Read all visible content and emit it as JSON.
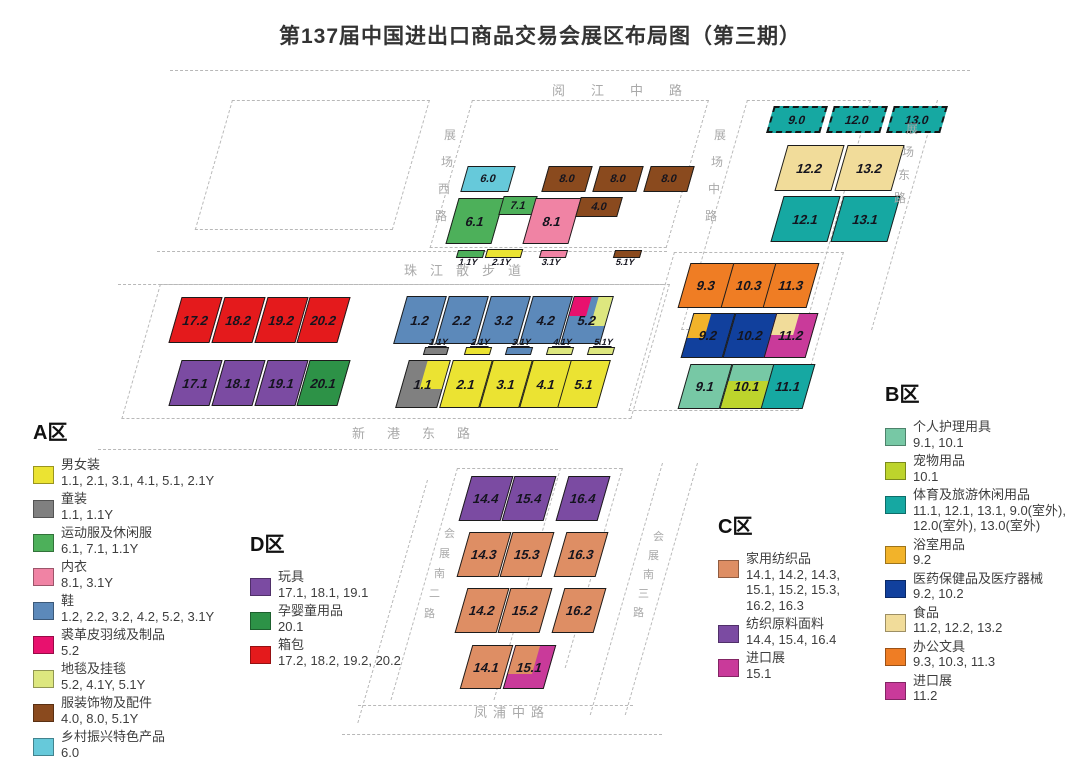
{
  "title": "第137届中国进出口商品交易会展区布局图（第三期）",
  "colors": {
    "yellow": "#ebe332",
    "gray": "#808080",
    "green": "#4db05a",
    "green2": "#2d9247",
    "pink": "#f083a4",
    "blue": "#5c89ba",
    "magentaA": "#e8116e",
    "lightgreen": "#dde77f",
    "brown": "#8a4a1e",
    "cyan": "#66c9da",
    "purple": "#7b4ba2",
    "red": "#e41a1c",
    "tan": "#de8e64",
    "magentaC": "#c93a9a",
    "tealLight": "#77c8a5",
    "yellowGreen": "#bdd42c",
    "teal": "#16a8a2",
    "amber": "#f2b32a",
    "darkblue": "#11409d",
    "cream": "#f1dc9a",
    "orange": "#ef7d24"
  },
  "roads": [
    {
      "name": "阅江中路"
    },
    {
      "name": "展场西路"
    },
    {
      "name": "展场中路"
    },
    {
      "name": "展场东路"
    },
    {
      "name": "珠江散步道"
    },
    {
      "name": "新港东路"
    },
    {
      "name": "会展南二路"
    },
    {
      "name": "会展南三路"
    },
    {
      "name": "凤浦中路"
    }
  ],
  "halls": [
    {
      "label": "9.0",
      "x": 770,
      "y": 106,
      "w": 54,
      "h": 27,
      "c": "teal",
      "outdoor": true,
      "fs": 12
    },
    {
      "label": "12.0",
      "x": 830,
      "y": 106,
      "w": 54,
      "h": 27,
      "c": "teal",
      "outdoor": true,
      "fs": 12
    },
    {
      "label": "13.0",
      "x": 890,
      "y": 106,
      "w": 54,
      "h": 27,
      "c": "teal",
      "outdoor": true,
      "fs": 12
    },
    {
      "label": "12.2",
      "x": 781,
      "y": 145,
      "w": 57,
      "h": 46,
      "c": "cream"
    },
    {
      "label": "13.2",
      "x": 841,
      "y": 145,
      "w": 57,
      "h": 46,
      "c": "cream"
    },
    {
      "label": "12.1",
      "x": 777,
      "y": 196,
      "w": 57,
      "h": 46,
      "c": "teal"
    },
    {
      "label": "13.1",
      "x": 837,
      "y": 196,
      "w": 57,
      "h": 46,
      "c": "teal"
    },
    {
      "label": "6.0",
      "x": 464,
      "y": 166,
      "w": 48,
      "h": 26,
      "c": "cyan",
      "fs": 11
    },
    {
      "label": "8.0",
      "x": 545,
      "y": 166,
      "w": 44,
      "h": 26,
      "c": "brown",
      "fs": 11
    },
    {
      "label": "8.0",
      "x": 596,
      "y": 166,
      "w": 44,
      "h": 26,
      "c": "brown",
      "fs": 11
    },
    {
      "label": "8.0",
      "x": 647,
      "y": 166,
      "w": 44,
      "h": 26,
      "c": "brown",
      "fs": 11
    },
    {
      "label": "6.1",
      "x": 452,
      "y": 198,
      "w": 46,
      "h": 46,
      "c": "green"
    },
    {
      "label": "7.1",
      "x": 501,
      "y": 196,
      "w": 34,
      "h": 19,
      "c": "green",
      "fs": 11
    },
    {
      "label": "8.1",
      "x": 529,
      "y": 198,
      "w": 46,
      "h": 46,
      "c": "pink"
    },
    {
      "label": "4.0",
      "x": 578,
      "y": 197,
      "w": 42,
      "h": 20,
      "c": "brown",
      "fs": 11
    },
    {
      "label": "1.1Y",
      "x": 457,
      "y": 250,
      "w": 27,
      "h": 8,
      "c": "green",
      "strip": "below"
    },
    {
      "label": "2.1Y",
      "x": 486,
      "y": 249,
      "w": 36,
      "h": 9,
      "c": "yellow",
      "strip": "below"
    },
    {
      "label": "3.1Y",
      "x": 540,
      "y": 250,
      "w": 27,
      "h": 8,
      "c": "pink",
      "strip": "below"
    },
    {
      "label": "5.1Y",
      "x": 614,
      "y": 250,
      "w": 27,
      "h": 8,
      "c": "brown",
      "strip": "below"
    },
    {
      "label": "17.2",
      "x": 175,
      "y": 297,
      "w": 41,
      "h": 46,
      "c": "red"
    },
    {
      "label": "18.2",
      "x": 218,
      "y": 297,
      "w": 41,
      "h": 46,
      "c": "red"
    },
    {
      "label": "19.2",
      "x": 261,
      "y": 297,
      "w": 41,
      "h": 46,
      "c": "red"
    },
    {
      "label": "20.2",
      "x": 303,
      "y": 297,
      "w": 41,
      "h": 46,
      "c": "red"
    },
    {
      "label": "17.1",
      "x": 175,
      "y": 360,
      "w": 41,
      "h": 46,
      "c": "purple"
    },
    {
      "label": "18.1",
      "x": 218,
      "y": 360,
      "w": 41,
      "h": 46,
      "c": "purple"
    },
    {
      "label": "19.1",
      "x": 261,
      "y": 360,
      "w": 41,
      "h": 46,
      "c": "purple"
    },
    {
      "label": "20.1",
      "x": 303,
      "y": 360,
      "w": 41,
      "h": 46,
      "c": "green2"
    },
    {
      "label": "1.2",
      "x": 400,
      "y": 296,
      "w": 40,
      "h": 48,
      "c": "blue"
    },
    {
      "label": "2.2",
      "x": 442,
      "y": 296,
      "w": 40,
      "h": 48,
      "c": "blue"
    },
    {
      "label": "3.2",
      "x": 484,
      "y": 296,
      "w": 40,
      "h": 48,
      "c": "blue"
    },
    {
      "label": "4.2",
      "x": 526,
      "y": 296,
      "w": 40,
      "h": 48,
      "c": "blue"
    },
    {
      "label": "5.2",
      "x": 567,
      "y": 296,
      "w": 40,
      "h": 48,
      "c": "blue",
      "parts": [
        {
          "c": "magentaA",
          "s": "left:0;top:0;width:45%;height:42%"
        },
        {
          "c": "lightgreen",
          "s": "left:62%;top:0;width:38%;height:62%"
        }
      ]
    },
    {
      "label": "1.1Y",
      "x": 424,
      "y": 347,
      "w": 24,
      "h": 8,
      "c": "gray",
      "strip": "above"
    },
    {
      "label": "2.1Y",
      "x": 465,
      "y": 347,
      "w": 26,
      "h": 8,
      "c": "yellow",
      "strip": "above"
    },
    {
      "label": "3.1Y",
      "x": 506,
      "y": 347,
      "w": 26,
      "h": 8,
      "c": "blue",
      "strip": "above"
    },
    {
      "label": "4.1Y",
      "x": 547,
      "y": 347,
      "w": 26,
      "h": 8,
      "c": "lightgreen",
      "strip": "above"
    },
    {
      "label": "5.1Y",
      "x": 588,
      "y": 347,
      "w": 26,
      "h": 8,
      "c": "lightgreen",
      "strip": "above"
    },
    {
      "label": "1.1",
      "x": 402,
      "y": 360,
      "w": 42,
      "h": 48,
      "c": "gray",
      "parts": [
        {
          "c": "yellow",
          "s": "left:45%;top:0;width:55%;height:60%"
        }
      ]
    },
    {
      "label": "2.1",
      "x": 446,
      "y": 360,
      "w": 40,
      "h": 48,
      "c": "yellow"
    },
    {
      "label": "3.1",
      "x": 486,
      "y": 360,
      "w": 40,
      "h": 48,
      "c": "yellow"
    },
    {
      "label": "4.1",
      "x": 526,
      "y": 360,
      "w": 40,
      "h": 48,
      "c": "yellow"
    },
    {
      "label": "5.1",
      "x": 564,
      "y": 360,
      "w": 40,
      "h": 48,
      "c": "yellow"
    },
    {
      "label": "9.3",
      "x": 684,
      "y": 263,
      "w": 44,
      "h": 45,
      "c": "orange"
    },
    {
      "label": "10.3",
      "x": 727,
      "y": 263,
      "w": 44,
      "h": 45,
      "c": "orange"
    },
    {
      "label": "11.3",
      "x": 769,
      "y": 263,
      "w": 44,
      "h": 45,
      "c": "orange"
    },
    {
      "label": "9.2",
      "x": 687,
      "y": 313,
      "w": 42,
      "h": 45,
      "c": "darkblue",
      "parts": [
        {
          "c": "amber",
          "s": "left:0;top:0;width:42%;height:55%"
        }
      ]
    },
    {
      "label": "10.2",
      "x": 729,
      "y": 313,
      "w": 42,
      "h": 45,
      "c": "darkblue"
    },
    {
      "label": "11.2",
      "x": 770,
      "y": 313,
      "w": 42,
      "h": 45,
      "c": "magentaC",
      "parts": [
        {
          "c": "cream",
          "s": "left:0;top:0;width:55%;height:48%"
        }
      ]
    },
    {
      "label": "9.1",
      "x": 684,
      "y": 364,
      "w": 42,
      "h": 45,
      "c": "tealLight"
    },
    {
      "label": "10.1",
      "x": 726,
      "y": 364,
      "w": 42,
      "h": 45,
      "c": "tealLight",
      "parts": [
        {
          "c": "yellowGreen",
          "s": "left:0;top:38%;width:100%;height:62%"
        }
      ]
    },
    {
      "label": "11.1",
      "x": 767,
      "y": 364,
      "w": 42,
      "h": 45,
      "c": "teal"
    },
    {
      "label": "14.4",
      "x": 465,
      "y": 476,
      "w": 42,
      "h": 45,
      "c": "purple"
    },
    {
      "label": "15.4",
      "x": 508,
      "y": 476,
      "w": 42,
      "h": 45,
      "c": "purple"
    },
    {
      "label": "16.4",
      "x": 562,
      "y": 476,
      "w": 42,
      "h": 45,
      "c": "purple"
    },
    {
      "label": "14.3",
      "x": 463,
      "y": 532,
      "w": 42,
      "h": 45,
      "c": "tan"
    },
    {
      "label": "15.3",
      "x": 506,
      "y": 532,
      "w": 42,
      "h": 45,
      "c": "tan"
    },
    {
      "label": "16.3",
      "x": 560,
      "y": 532,
      "w": 42,
      "h": 45,
      "c": "tan"
    },
    {
      "label": "14.2",
      "x": 461,
      "y": 588,
      "w": 42,
      "h": 45,
      "c": "tan"
    },
    {
      "label": "15.2",
      "x": 504,
      "y": 588,
      "w": 42,
      "h": 45,
      "c": "tan"
    },
    {
      "label": "16.2",
      "x": 558,
      "y": 588,
      "w": 42,
      "h": 45,
      "c": "tan"
    },
    {
      "label": "14.1",
      "x": 466,
      "y": 645,
      "w": 41,
      "h": 44,
      "c": "tan"
    },
    {
      "label": "15.1",
      "x": 509,
      "y": 645,
      "w": 41,
      "h": 44,
      "c": "magentaC",
      "parts": [
        {
          "c": "tan",
          "s": "left:0;top:0;width:62%;height:66%"
        }
      ]
    }
  ],
  "legend": {
    "zones": [
      {
        "id": "A",
        "title": "A区",
        "items": [
          {
            "name": "男女装",
            "codes": "1.1, 2.1, 3.1, 4.1, 5.1, 2.1Y",
            "color": "yellow"
          },
          {
            "name": "童装",
            "codes": "1.1, 1.1Y",
            "color": "gray"
          },
          {
            "name": "运动服及休闲服",
            "codes": "6.1, 7.1, 1.1Y",
            "color": "green"
          },
          {
            "name": "内衣",
            "codes": "8.1, 3.1Y",
            "color": "pink"
          },
          {
            "name": "鞋",
            "codes": "1.2, 2.2, 3.2, 4.2, 5.2, 3.1Y",
            "color": "blue"
          },
          {
            "name": "裘革皮羽绒及制品",
            "codes": "5.2",
            "color": "magentaA"
          },
          {
            "name": "地毯及挂毯",
            "codes": "5.2, 4.1Y, 5.1Y",
            "color": "lightgreen"
          },
          {
            "name": "服装饰物及配件",
            "codes": "4.0, 8.0, 5.1Y",
            "color": "brown"
          },
          {
            "name": "乡村振兴特色产品",
            "codes": "6.0",
            "color": "cyan"
          }
        ]
      },
      {
        "id": "D",
        "title": "D区",
        "items": [
          {
            "name": "玩具",
            "codes": "17.1, 18.1, 19.1",
            "color": "purple"
          },
          {
            "name": "孕婴童用品",
            "codes": "20.1",
            "color": "green2"
          },
          {
            "name": "箱包",
            "codes": "17.2, 18.2, 19.2, 20.2",
            "color": "red"
          }
        ]
      },
      {
        "id": "C",
        "title": "C区",
        "items": [
          {
            "name": "家用纺织品",
            "codes": "14.1, 14.2, 14.3, 15.1, 15.2, 15.3, 16.2, 16.3",
            "color": "tan"
          },
          {
            "name": "纺织原料面料",
            "codes": "14.4, 15.4, 16.4",
            "color": "purple"
          },
          {
            "name": "进口展",
            "codes": "15.1",
            "color": "magentaC"
          }
        ]
      },
      {
        "id": "B",
        "title": "B区",
        "items": [
          {
            "name": "个人护理用具",
            "codes": "9.1, 10.1",
            "color": "tealLight"
          },
          {
            "name": "宠物用品",
            "codes": "10.1",
            "color": "yellowGreen"
          },
          {
            "name": "体育及旅游休闲用品",
            "codes": "11.1, 12.1, 13.1, 9.0(室外), 12.0(室外), 13.0(室外)",
            "color": "teal"
          },
          {
            "name": "浴室用品",
            "codes": "9.2",
            "color": "amber"
          },
          {
            "name": "医药保健品及医疗器械",
            "codes": "9.2, 10.2",
            "color": "darkblue"
          },
          {
            "name": "食品",
            "codes": "11.2, 12.2, 13.2",
            "color": "cream"
          },
          {
            "name": "办公文具",
            "codes": "9.3, 10.3, 11.3",
            "color": "orange"
          },
          {
            "name": "进口展",
            "codes": "11.2",
            "color": "magentaC"
          }
        ]
      }
    ]
  }
}
